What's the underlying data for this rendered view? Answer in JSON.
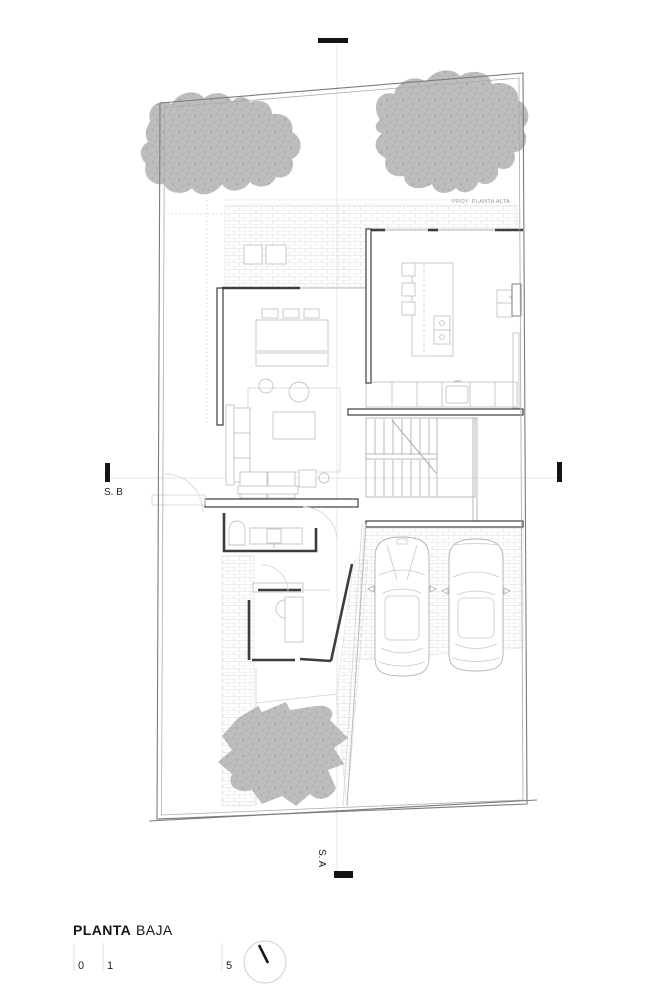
{
  "drawing": {
    "proy_label": "PROY. PLANTA ALTA",
    "section_b_label": "S. B",
    "section_a_label": "S. A"
  },
  "footer": {
    "title_bold": "PLANTA",
    "title_light": "BAJA",
    "scale": [
      "0",
      "1",
      "5"
    ]
  },
  "colors": {
    "wall_dark": "#3d3d3d",
    "marker_black": "#141414",
    "canopy_gray": "#b8b8b8",
    "hatch_line": "#dcdcdc",
    "background": "#ffffff"
  }
}
